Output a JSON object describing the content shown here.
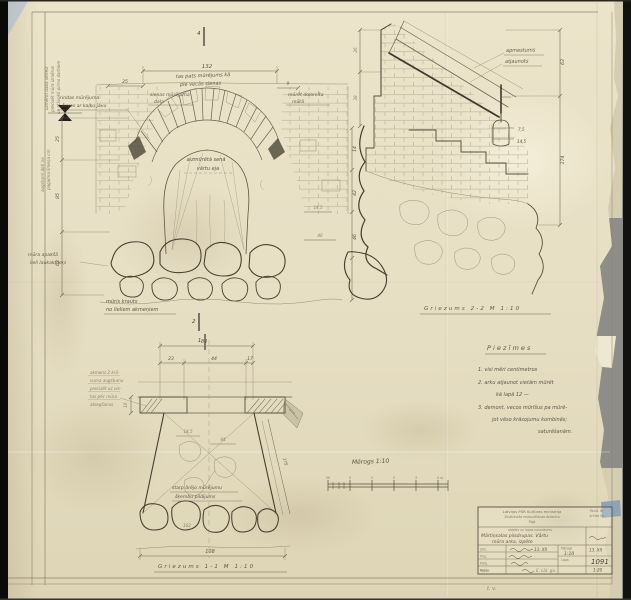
{
  "margin": {
    "rot_note_1": [
      "uzmērot dabā vēlreiz",
      "precizēt mūra izmērus",
      "un stāvokli pirms darbiem"
    ],
    "rot_note_2": [
      "augstumi doti no",
      "pagalma līmeņa cm"
    ]
  },
  "arch": {
    "section_mark_top": "4",
    "section_mark_bottom": "2",
    "dim_width": "132",
    "dim_left_small": "25",
    "dim_right_small": "9",
    "note_top_1": "tas pats mūrējums kā",
    "note_top_2": "pie vecās sienas",
    "label_masonry_1": "sienas mūrējuma",
    "label_masonry_2": "daļa",
    "label_right_1": "mūrēt dolomīta",
    "label_right_2": "mūrā",
    "label_opening_1": "aizmūrētā senā",
    "label_opening_2": "vārtu eja",
    "label_left_1": "rindas mūrējuma",
    "label_left_2": "šuves ar kaļķu javu",
    "label_boulders_1": "mūra apakšā",
    "label_boulders_2": "lieli laukakmeņi",
    "caption_1": "mūris krauts",
    "caption_2": "no lieliem akmeņiem",
    "dims_left": [
      "25",
      "85",
      "63"
    ],
    "dims_right": [
      "14",
      "42",
      "46"
    ],
    "dim_inner_a": "14,5",
    "dim_inner_b": "40"
  },
  "stair": {
    "label_plaster_1": "apmestums",
    "label_plaster_2": "atjaunots",
    "dim_right_1": "63",
    "dim_right_2": "174",
    "dim_left_1": "26",
    "dim_left_2": "38",
    "dim_a": "7,5",
    "dim_b": "14,5",
    "caption": "Griezums 2-2  M 1:10"
  },
  "footing": {
    "section_mark": "1",
    "dim_total": "84",
    "dim_seg_1": "23",
    "dim_seg_2": "44",
    "dim_seg_3": "17",
    "dim_inner_1": "14,5",
    "dim_inner_2": "44",
    "dim_ledge": "16",
    "dim_slope": "175",
    "dim_stone": "102",
    "dim_bottom": "108",
    "side_note": [
      "akmens 2 krā-",
      "vuma augstumu",
      "precizēt uz vie-",
      "tas pēc mūra",
      "atsegšanas"
    ],
    "note_fill_1": "starp ārējo mūrējumu",
    "note_fill_2": "šķembu pildījums",
    "caption": "Griezums 1-1  M 1:10"
  },
  "scalebar": {
    "label": "Mērogs 1:10",
    "ticks": [
      "50",
      "0",
      "1",
      "2",
      "3",
      "4 m"
    ]
  },
  "notes": {
    "heading": "Piezīmes",
    "line_1": "1. visi mēri centimetros",
    "line_2": "2. arku atjaunot vietām mūrēt",
    "line_3": "kā lapā 12 —",
    "line_4": "3. demont. vecos mūrīšus pa mūrē-",
    "line_5": "jot vēso krāsojumu kombinēs;",
    "line_6": "saturēšanām."
  },
  "titleblock": {
    "org_1": "Latvijas PSR Kultūras ministrija",
    "org_2": "Zinātniskās restaurēšanas darbnīca",
    "org_3": "Rīgā",
    "corner_1": "Pasūt. Nr.",
    "corner_2": "Arhīva Nr.",
    "object_caption": "objekts un lapas nosaukums",
    "object_1": "Mārtiņsalas pilsdrupas. Vārtu",
    "object_2": "mūra arka, izpēte",
    "row_label_1": "Zīm.",
    "row_label_2": "Proj.",
    "row_label_3": "Pārb.",
    "row_label_4": "Apst.",
    "scale_label": "Mērogs",
    "scale_value": "1:10",
    "sheet_label": "Lapa",
    "date_value": "13. XII",
    "sheet_number": "1091",
    "scale_alt": "1:20",
    "copy_label": "Kopija",
    "copy_value": "E. Līd. ga."
  },
  "misc": {
    "note_below_block": "t. v."
  }
}
